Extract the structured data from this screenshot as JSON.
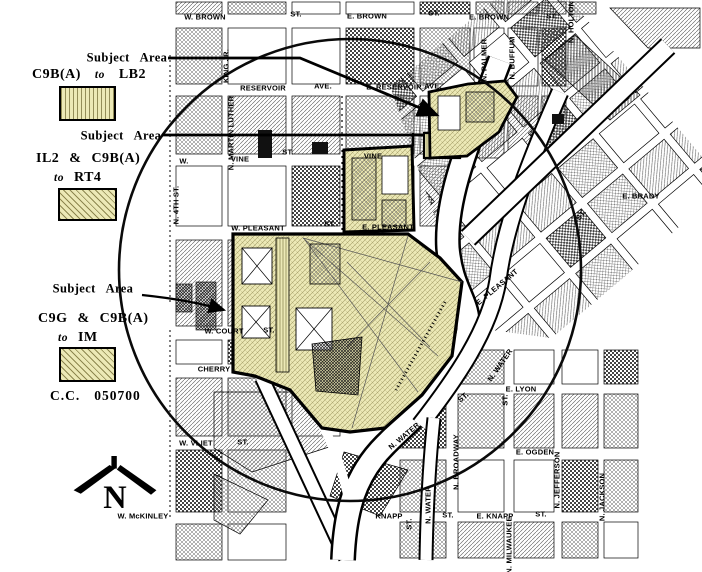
{
  "legend": {
    "entries": [
      {
        "callout": "Subject Area",
        "from": "C9B(A)",
        "connector": "to",
        "to": "LB2",
        "swatch": "stripes"
      },
      {
        "callout": "Subject Area",
        "from": "IL2 & C9B(A)",
        "connector": "to",
        "to": "RT4",
        "swatch": "hatch"
      },
      {
        "callout": "Subject Area",
        "from": "C9G & C9B(A)",
        "connector": "to",
        "to": "IM",
        "swatch": "hatch"
      }
    ],
    "file_label": "C.C.",
    "file_number": "050700"
  },
  "compass": {
    "letter": "N"
  },
  "colors": {
    "subject_fill": "#ece9b6",
    "ink": "#000000"
  },
  "map": {
    "streets": [
      {
        "t": "W. BROWN",
        "x": 205,
        "y": 17,
        "r": 0
      },
      {
        "t": "ST.",
        "x": 296,
        "y": 14,
        "r": 0
      },
      {
        "t": "E. BROWN",
        "x": 367,
        "y": 16,
        "r": 0
      },
      {
        "t": "ST.",
        "x": 434,
        "y": 13,
        "r": 0
      },
      {
        "t": "E. BROWN",
        "x": 489,
        "y": 17,
        "r": 0
      },
      {
        "t": "ST.",
        "x": 552,
        "y": 16,
        "r": 0
      },
      {
        "t": "RESERVOIR",
        "x": 263,
        "y": 88,
        "r": 0
      },
      {
        "t": "AVE.",
        "x": 323,
        "y": 86,
        "r": 0
      },
      {
        "t": "E. RESERVOIR",
        "x": 394,
        "y": 87,
        "r": 0
      },
      {
        "t": "AVE.",
        "x": 433,
        "y": 86,
        "r": 0
      },
      {
        "t": "W.",
        "x": 184,
        "y": 161,
        "r": 0
      },
      {
        "t": "VINE",
        "x": 240,
        "y": 159,
        "r": 0
      },
      {
        "t": "ST.",
        "x": 288,
        "y": 152,
        "r": 0
      },
      {
        "t": "VINE",
        "x": 373,
        "y": 156,
        "r": 0
      },
      {
        "t": "W. PLEASANT",
        "x": 258,
        "y": 228,
        "r": 0
      },
      {
        "t": "ST.",
        "x": 330,
        "y": 224,
        "r": 0
      },
      {
        "t": "E. PLEASANT",
        "x": 388,
        "y": 227,
        "r": 0
      },
      {
        "t": "E. PLEASANT",
        "x": 497,
        "y": 287,
        "r": -40
      },
      {
        "t": "W. COURT",
        "x": 224,
        "y": 331,
        "r": 0
      },
      {
        "t": "ST.",
        "x": 269,
        "y": 330,
        "r": 0
      },
      {
        "t": "CHERRY",
        "x": 214,
        "y": 369,
        "r": 0
      },
      {
        "t": "W. VLIET",
        "x": 196,
        "y": 443,
        "r": 0
      },
      {
        "t": "ST.",
        "x": 243,
        "y": 442,
        "r": 0
      },
      {
        "t": "W. McKINLEY",
        "x": 143,
        "y": 516,
        "r": 0
      },
      {
        "t": "KNAPP",
        "x": 389,
        "y": 516,
        "r": 0
      },
      {
        "t": "ST.",
        "x": 448,
        "y": 515,
        "r": 0
      },
      {
        "t": "E. KNAPP",
        "x": 495,
        "y": 516,
        "r": 0
      },
      {
        "t": "ST.",
        "x": 541,
        "y": 514,
        "r": 0
      },
      {
        "t": "E. OGDEN",
        "x": 535,
        "y": 452,
        "r": 0
      },
      {
        "t": "E. LYON",
        "x": 521,
        "y": 389,
        "r": 0
      },
      {
        "t": "E. BRADY",
        "x": 641,
        "y": 196,
        "r": 0
      },
      {
        "t": "N. 4TH ST.",
        "x": 176,
        "y": 205,
        "r": -90
      },
      {
        "t": "KING JR.",
        "x": 226,
        "y": 66,
        "r": -90
      },
      {
        "t": "N. MARTIN LUTHER",
        "x": 231,
        "y": 133,
        "r": -90
      },
      {
        "t": "N. PALMER",
        "x": 484,
        "y": 60,
        "r": -90
      },
      {
        "t": "N. BUFFUM",
        "x": 512,
        "y": 58,
        "r": -90
      },
      {
        "t": "N. HOLTON",
        "x": 571,
        "y": 22,
        "r": -90
      },
      {
        "t": "N. WATER",
        "x": 500,
        "y": 365,
        "r": -55
      },
      {
        "t": "N. WATER",
        "x": 404,
        "y": 436,
        "r": -40
      },
      {
        "t": "N. WATER",
        "x": 428,
        "y": 505,
        "r": -90
      },
      {
        "t": "ST.",
        "x": 463,
        "y": 397,
        "r": -40
      },
      {
        "t": "ST.",
        "x": 505,
        "y": 400,
        "r": -90
      },
      {
        "t": "ST.",
        "x": 581,
        "y": 215,
        "r": -50
      },
      {
        "t": "N. BROADWAY",
        "x": 456,
        "y": 462,
        "r": -90
      },
      {
        "t": "N. MILWAUKEE",
        "x": 509,
        "y": 545,
        "r": -90
      },
      {
        "t": "N. JEFFERSON",
        "x": 557,
        "y": 480,
        "r": -90
      },
      {
        "t": "N. JACKSON",
        "x": 602,
        "y": 497,
        "r": -90
      },
      {
        "t": "ST.",
        "x": 409,
        "y": 524,
        "r": -90
      }
    ]
  }
}
